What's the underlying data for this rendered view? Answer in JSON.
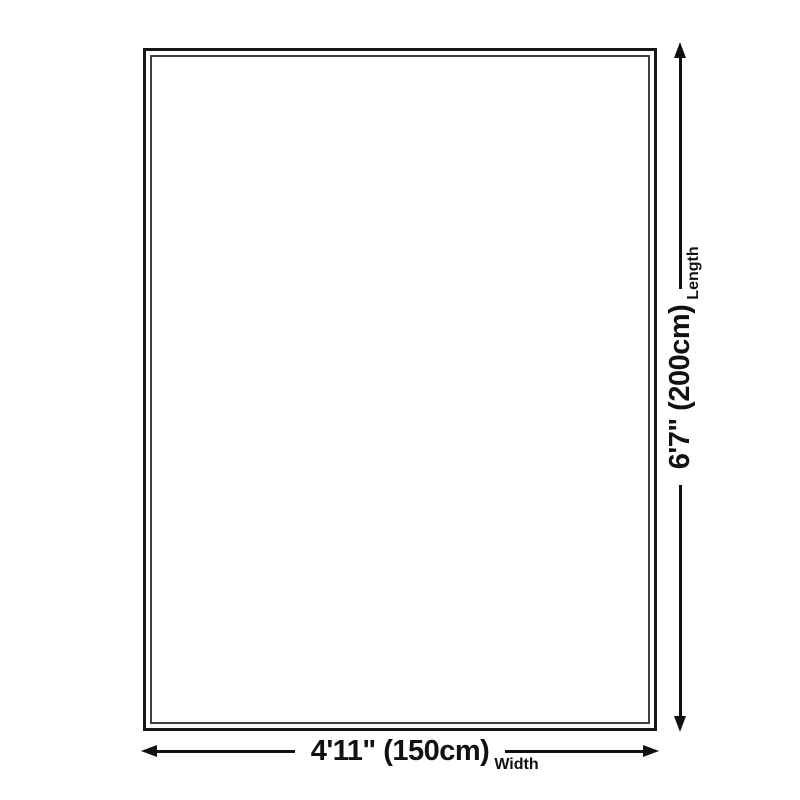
{
  "diagram": {
    "type": "product-size-diagram",
    "background_color": "#ffffff",
    "line_color": "#111111",
    "rug": {
      "outer_border_color": "#161616",
      "inner_border_color": "#404040",
      "fill_color": "#ffffff"
    },
    "dimensions": {
      "length": {
        "value": "6'7\" (200cm)",
        "label": "Length",
        "axis": "vertical"
      },
      "width": {
        "value": "4'11\" (150cm)",
        "label": "Width",
        "axis": "horizontal"
      }
    },
    "icons": {
      "length_axis": [
        "arrow-down-icon",
        "arrow-up-icon"
      ],
      "width_axis": [
        "arrow-left-icon",
        "arrow-right-icon"
      ]
    }
  }
}
